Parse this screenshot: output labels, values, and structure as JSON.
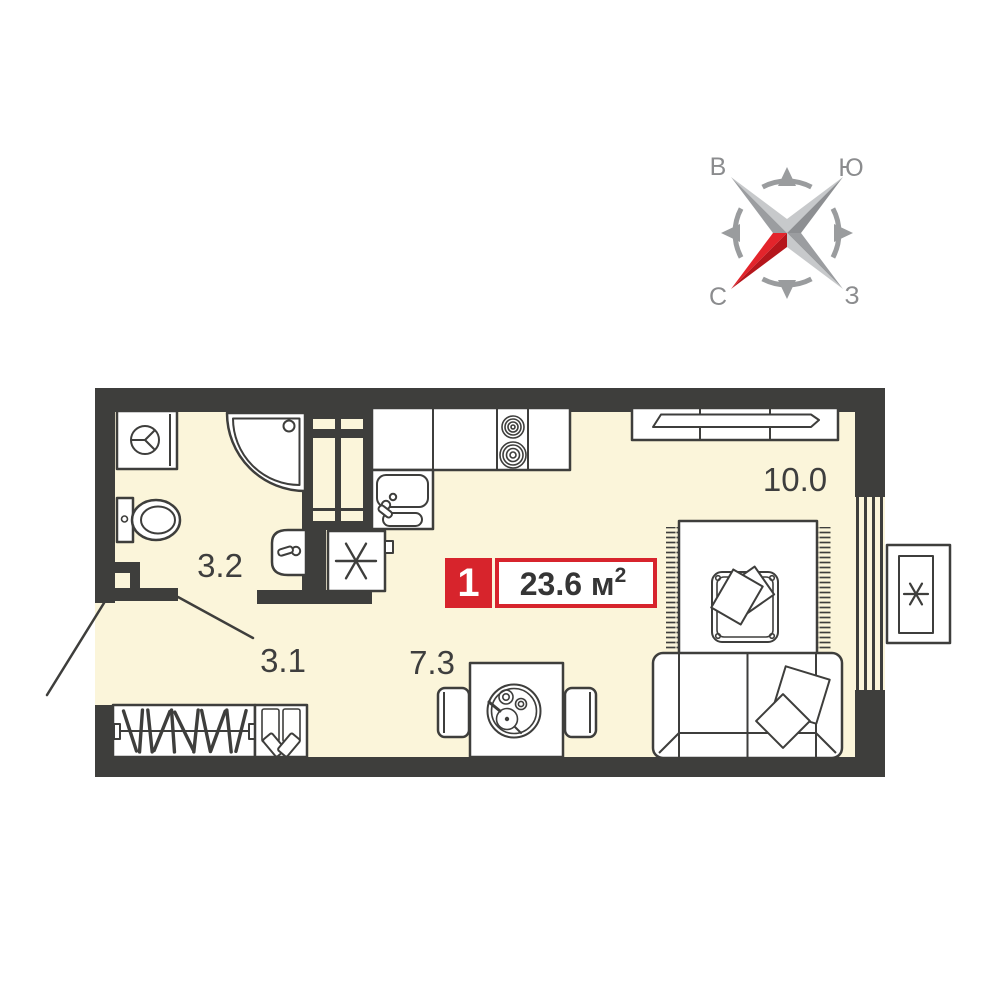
{
  "compass": {
    "letters": {
      "top_left": "В",
      "top_right": "Ю",
      "bottom_left": "С",
      "bottom_right": "З"
    },
    "colors": {
      "gray_light": "#c7c9cb",
      "gray_mid": "#9b9da0",
      "gray_dark": "#8d8f92",
      "ring": "#9a9c9e",
      "letter": "#8b8c8e",
      "red": "#e3242b",
      "red_dark": "#b5161c"
    }
  },
  "plan": {
    "badge": {
      "number": "1",
      "area": "23.6 м",
      "area_sup": "2"
    },
    "rooms": {
      "bathroom": {
        "label": "3.2"
      },
      "hallway": {
        "label": "3.1"
      },
      "kitchen": {
        "label": "7.3"
      },
      "living": {
        "label": "10.0"
      }
    },
    "colors": {
      "floor": "#fbf5da",
      "wall": "#3e3e3c",
      "line": "#3e3e3c",
      "badge_red": "#d7242c",
      "badge_text": "#353535"
    }
  }
}
